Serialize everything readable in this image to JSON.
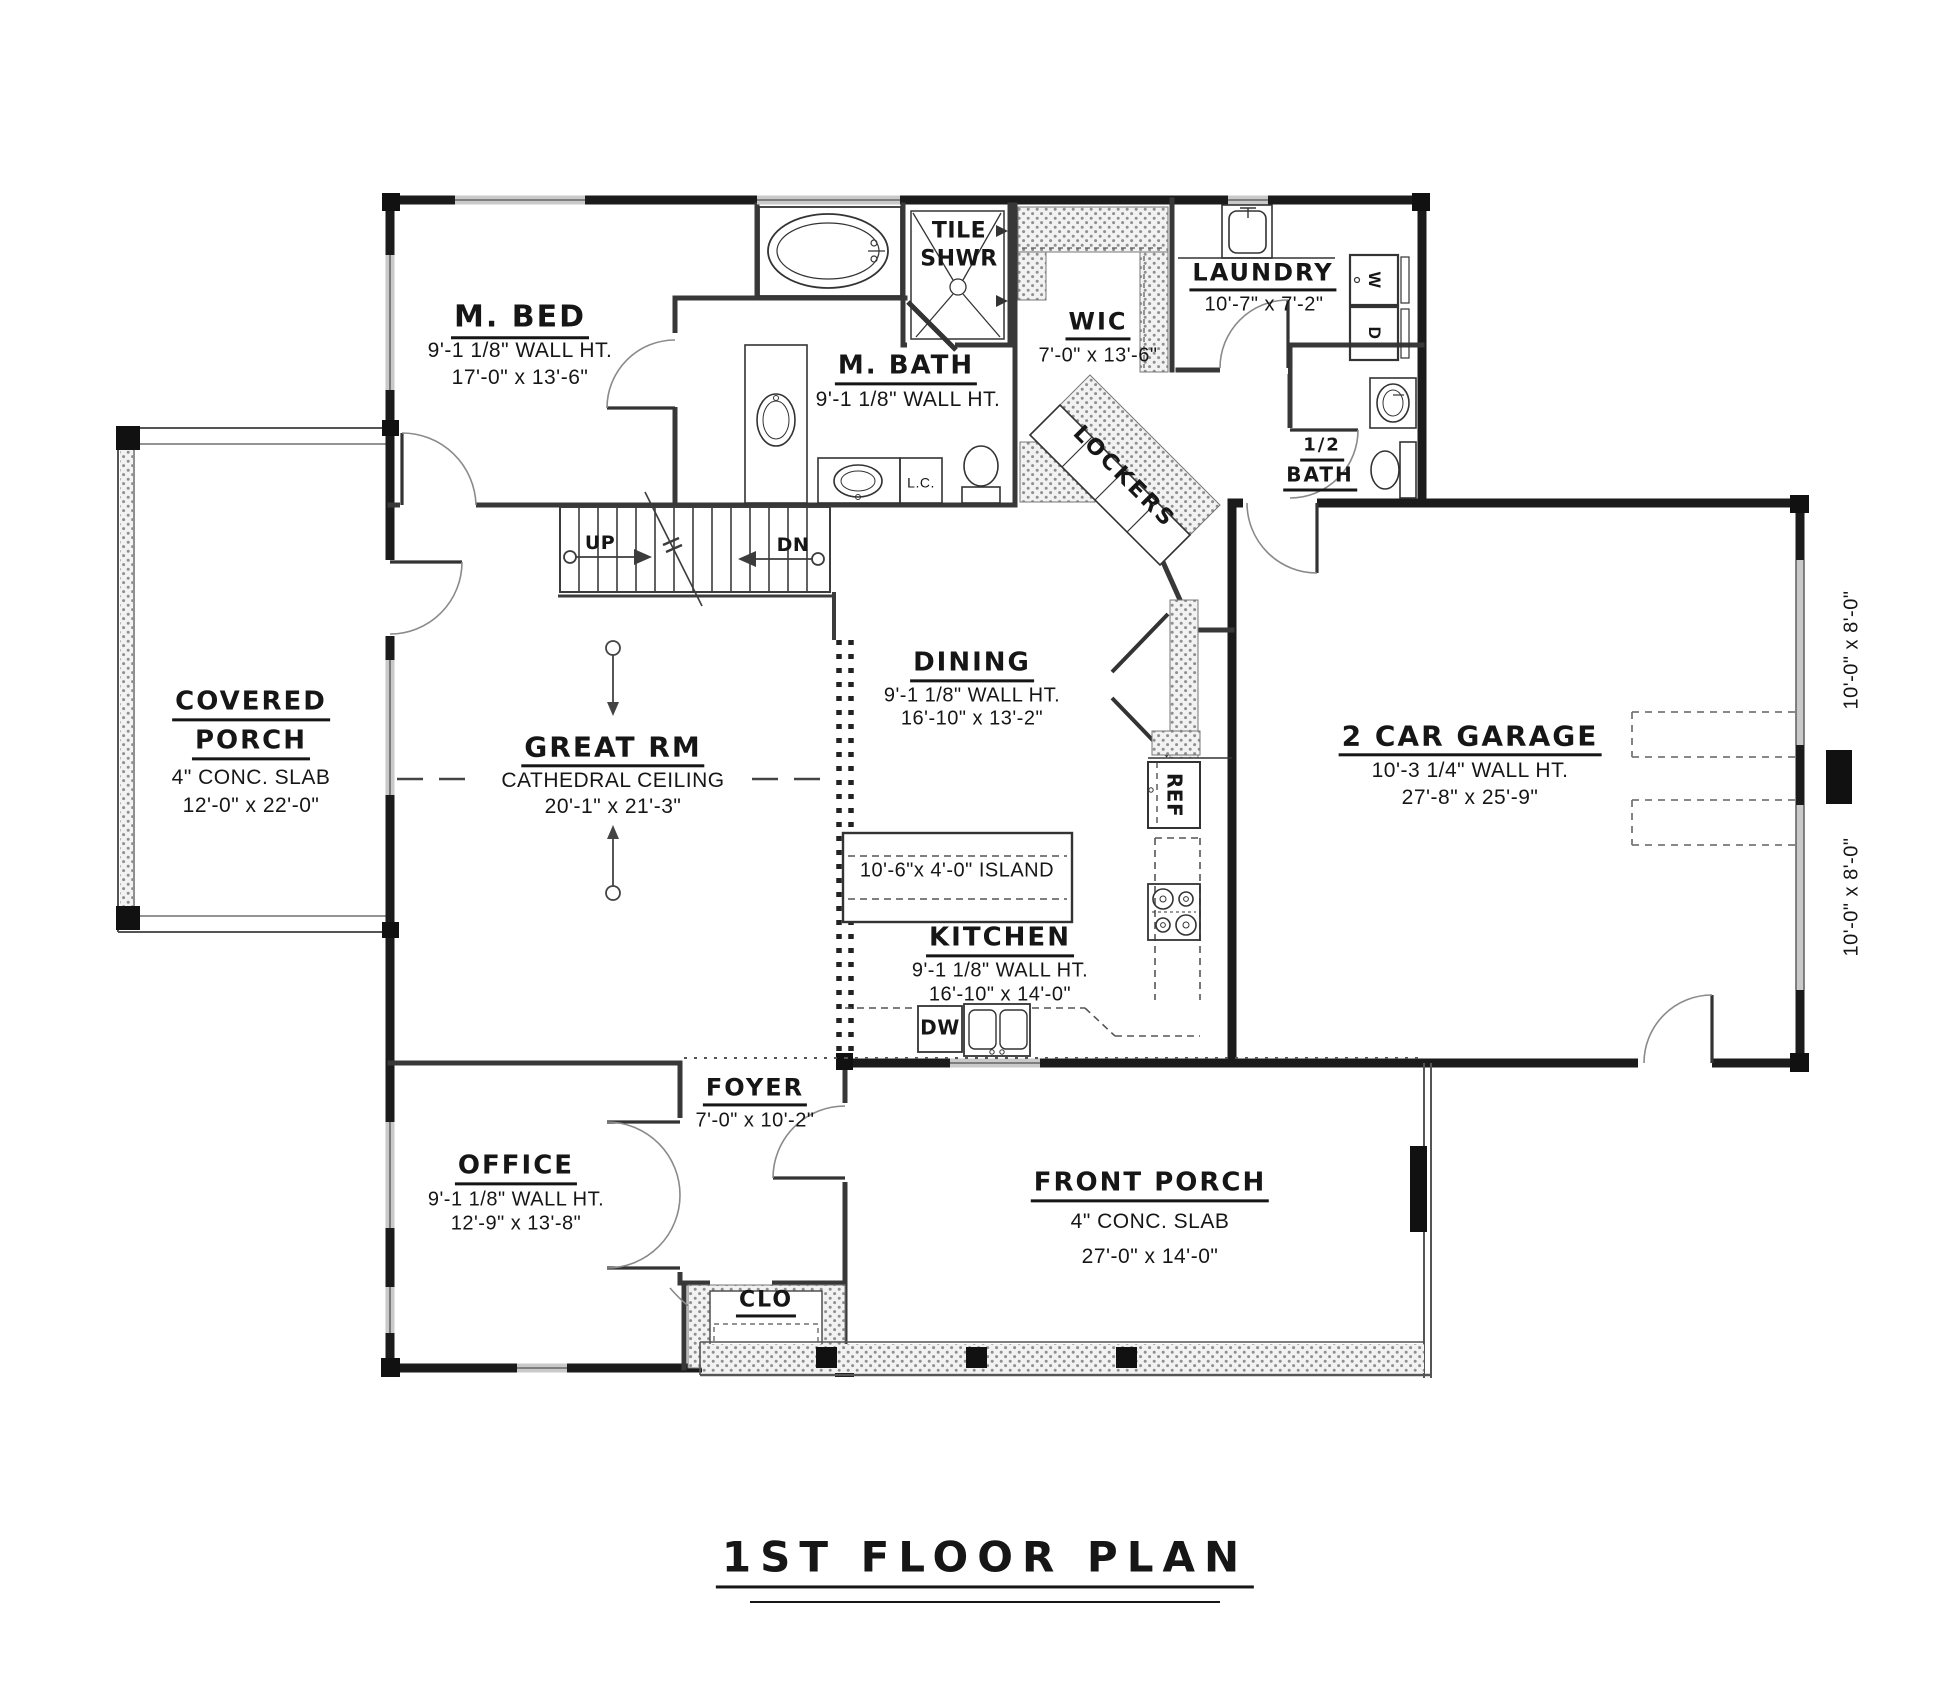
{
  "title": "1ST FLOOR PLAN",
  "rooms": {
    "m_bed": {
      "name": "M. BED",
      "wall_ht": "9'-1 1/8\" WALL HT.",
      "size": "17'-0\" x 13'-6\""
    },
    "tile_shwr": {
      "line1": "TILE",
      "line2": "SHWR"
    },
    "m_bath": {
      "name": "M. BATH",
      "wall_ht": "9'-1 1/8\" WALL HT."
    },
    "wic": {
      "name": "WIC",
      "size": "7'-0\" x 13'-6\""
    },
    "laundry": {
      "name": "LAUNDRY",
      "size": "10'-7\" x 7'-2\""
    },
    "half_bath": {
      "line1": "1/2",
      "line2": "BATH"
    },
    "covered_porch": {
      "name1": "COVERED",
      "name2": "PORCH",
      "slab": "4\" CONC. SLAB",
      "size": "12'-0\" x 22'-0\""
    },
    "great_rm": {
      "name": "GREAT RM",
      "ceiling": "CATHEDRAL CEILING",
      "size": "20'-1\" x 21'-3\""
    },
    "dining": {
      "name": "DINING",
      "wall_ht": "9'-1 1/8\" WALL HT.",
      "size": "16'-10\" x 13'-2\""
    },
    "garage": {
      "name": "2 CAR GARAGE",
      "wall_ht": "10'-3 1/4\" WALL HT.",
      "size": "27'-8\" x 25'-9\""
    },
    "kitchen": {
      "name": "KITCHEN",
      "wall_ht": "9'-1 1/8\" WALL HT.",
      "size": "16'-10\" x 14'-0\"",
      "island": "10'-6\"x 4'-0\" ISLAND"
    },
    "foyer": {
      "name": "FOYER",
      "size": "7'-0\" x 10'-2\""
    },
    "office": {
      "name": "OFFICE",
      "wall_ht": "9'-1 1/8\" WALL HT.",
      "size": "12'-9\" x 13'-8\""
    },
    "clo": {
      "name": "CLO"
    },
    "front_porch": {
      "name": "FRONT PORCH",
      "slab": "4\" CONC. SLAB",
      "size": "27'-0\" x 14'-0\""
    }
  },
  "fixtures": {
    "up": "UP",
    "dn": "DN",
    "linen": "L.C.",
    "lockers": "LOCKERS",
    "ref": "REF",
    "dw": "DW",
    "washer": "W",
    "dryer": "D"
  },
  "garage_doors": {
    "upper": "10'-0\" x 8'-0\"",
    "lower": "10'-0\" x 8'-0\""
  },
  "colors": {
    "ink": "#1b1b1b",
    "wall_window": "#c9c9c9",
    "hatch_dot": "#8f8f8f",
    "background": "#ffffff"
  }
}
